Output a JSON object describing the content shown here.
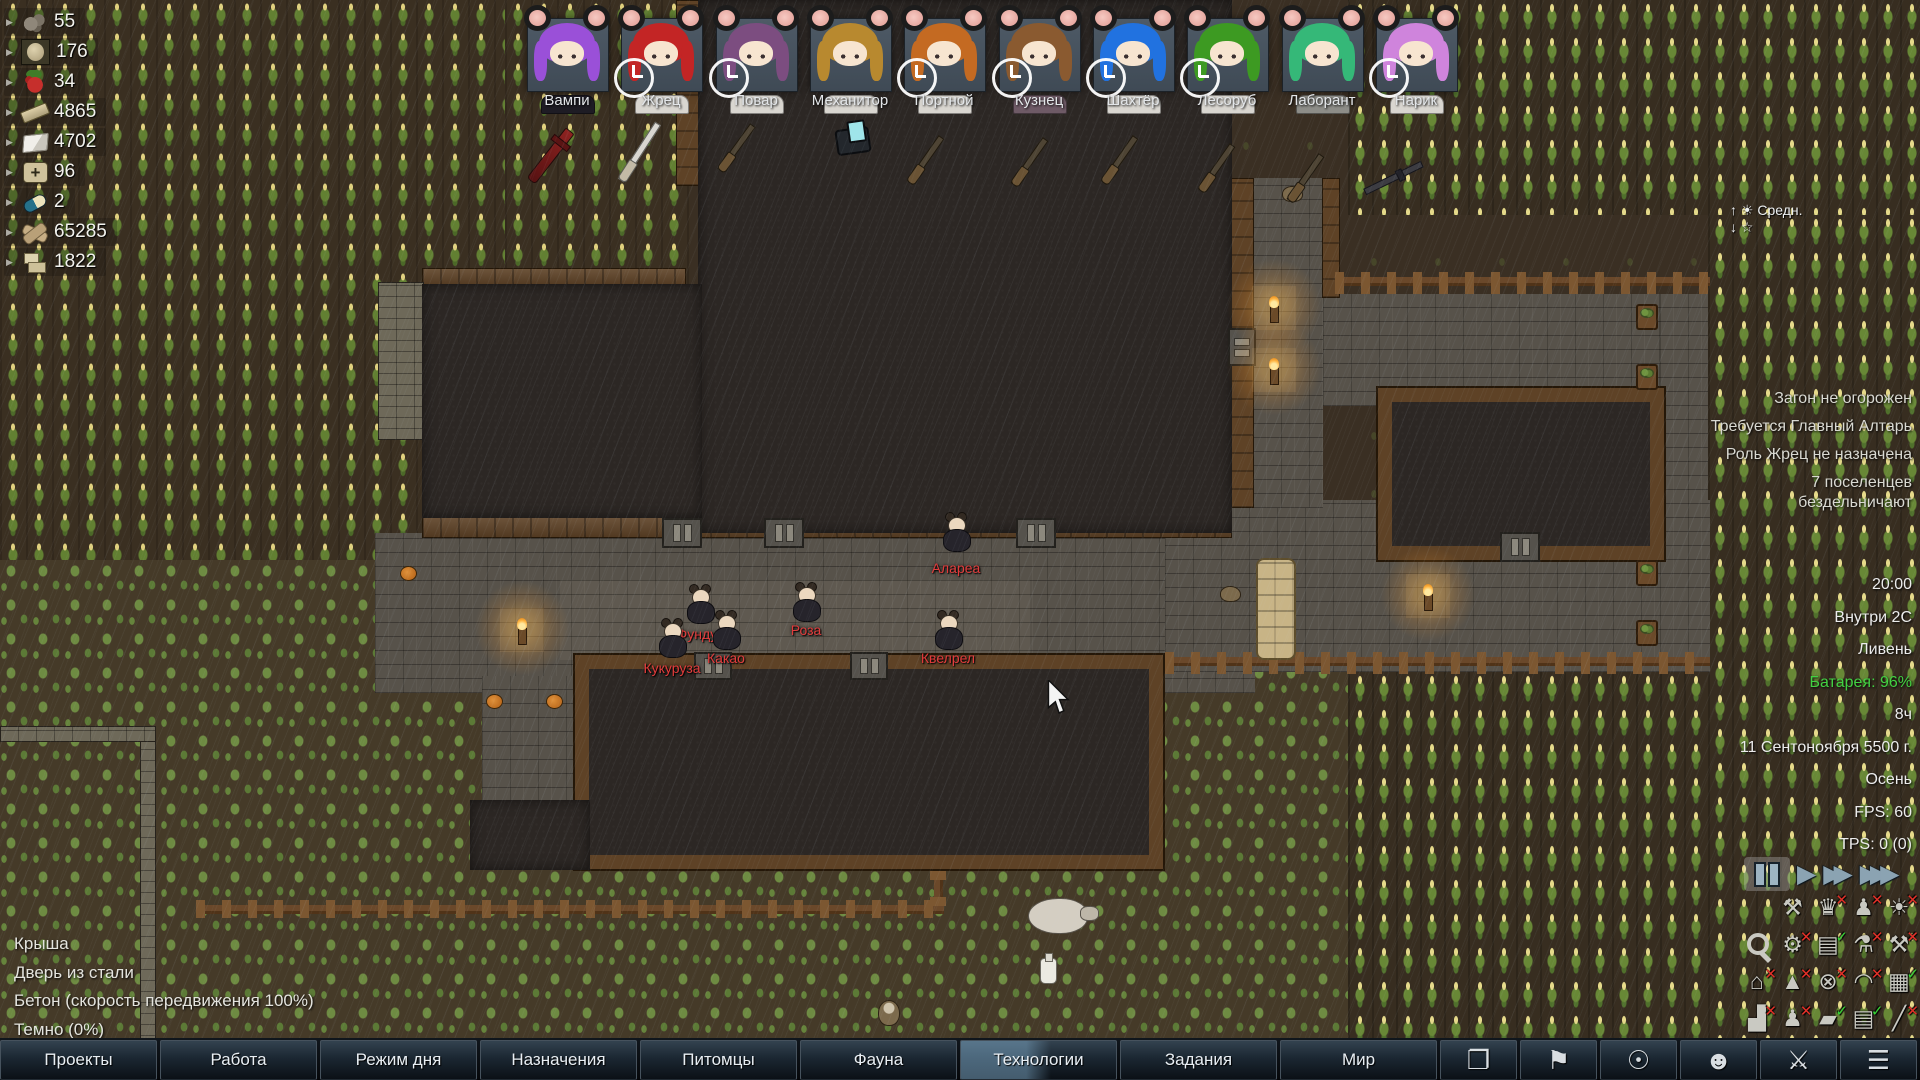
{
  "hud": {
    "resources": [
      {
        "icon": "stone-chunks",
        "count": "55"
      },
      {
        "icon": "egg",
        "count": "176"
      },
      {
        "icon": "berries",
        "count": "34"
      },
      {
        "icon": "steel",
        "count": "4865"
      },
      {
        "icon": "cloth",
        "count": "4702"
      },
      {
        "icon": "medicine",
        "count": "96"
      },
      {
        "icon": "pill",
        "count": "2"
      },
      {
        "icon": "wood",
        "count": "65285"
      },
      {
        "icon": "stone-blocks",
        "count": "1822"
      }
    ],
    "colonists": [
      {
        "name": "Вампи",
        "hair": "#9a50d8",
        "body": "#1e1c24",
        "clock": false
      },
      {
        "name": "Жрец",
        "hair": "#c32525",
        "body": "#d9d6d0",
        "clock": true
      },
      {
        "name": "Повар",
        "hair": "#7c4d80",
        "body": "#d9d6d0",
        "clock": true
      },
      {
        "name": "Механитор",
        "hair": "#b8892f",
        "body": "#d9d6d0",
        "clock": false
      },
      {
        "name": "Портной",
        "hair": "#c46a22",
        "body": "#d9d6d0",
        "clock": true
      },
      {
        "name": "Кузнец",
        "hair": "#8a5a30",
        "body": "#6e5a66",
        "clock": true
      },
      {
        "name": "Шахтёр",
        "hair": "#2172e0",
        "body": "#d9d6d0",
        "clock": true
      },
      {
        "name": "Лесоруб",
        "hair": "#3d9a22",
        "body": "#d9d6d0",
        "clock": true
      },
      {
        "name": "Лаборант",
        "hair": "#35b878",
        "body": "#8d8d88",
        "clock": false
      },
      {
        "name": "Нарик",
        "hair": "#cf84dc",
        "body": "#d9d6d0",
        "clock": true
      }
    ],
    "weather_widget": {
      "line1": "↑ ☀ Средн.",
      "line2": "↓ ☆"
    },
    "alerts": [
      "Загон не огорожен",
      "Требуется Главный Алтарь",
      "Роль Жрец не назначена",
      "7 поселенцев бездельничают"
    ],
    "status": [
      {
        "text": "20:00"
      },
      {
        "text": "Внутри 2C"
      },
      {
        "text": "Ливень"
      },
      {
        "text": "Батарея: 96%",
        "color": "#42d142"
      },
      {
        "text": "8ч"
      },
      {
        "text": "11 Сентоноября 5500 г."
      },
      {
        "text": "Осень"
      },
      {
        "text": "FPS: 60"
      },
      {
        "text": "TPS: 0 (0)"
      }
    ],
    "playback": {
      "selected": "pause",
      "speeds": [
        "pause",
        "play",
        "fast",
        "superfast"
      ]
    },
    "toggles": [
      {
        "name": "tools",
        "glyph": "⚒",
        "state": null
      },
      {
        "name": "trophy",
        "glyph": "♛",
        "state": "x"
      },
      {
        "name": "pawn-paths",
        "glyph": "♟",
        "state": "x"
      },
      {
        "name": "lightbulb",
        "glyph": "☀",
        "state": "x"
      },
      {
        "name": "search",
        "glyph": "mag",
        "state": null
      },
      {
        "name": "factory",
        "glyph": "⚙",
        "state": "x"
      },
      {
        "name": "storage",
        "glyph": "▤",
        "state": "check"
      },
      {
        "name": "thermometer",
        "glyph": "⚗",
        "state": "x"
      },
      {
        "name": "hatchet",
        "glyph": "⚒",
        "state": "x"
      },
      {
        "name": "home-area",
        "glyph": "⌂",
        "state": "x"
      },
      {
        "name": "terrain",
        "glyph": "▲",
        "state": "x"
      },
      {
        "name": "fan",
        "glyph": "⊗",
        "state": "x"
      },
      {
        "name": "roof-overlay",
        "glyph": "◠",
        "state": "x"
      },
      {
        "name": "tiles",
        "glyph": "▦",
        "state": "check"
      },
      {
        "name": "chart",
        "glyph": "▟",
        "state": "x"
      },
      {
        "name": "statue",
        "glyph": "♟",
        "state": "x"
      },
      {
        "name": "zones",
        "glyph": "▰",
        "state": "check"
      },
      {
        "name": "panels",
        "glyph": "▤",
        "state": "check"
      },
      {
        "name": "plans",
        "glyph": "╱",
        "state": "x"
      }
    ],
    "cell_info": [
      "Крыша",
      "Дверь из стали",
      "Бетон (скорость передвижения 100%)",
      "Темно (0%)"
    ],
    "bottom_bar": {
      "buttons": [
        {
          "label": "Проекты",
          "selected": false
        },
        {
          "label": "Работа",
          "selected": false
        },
        {
          "label": "Режим дня",
          "selected": false
        },
        {
          "label": "Назначения",
          "selected": false
        },
        {
          "label": "Питомцы",
          "selected": false
        },
        {
          "label": "Фауна",
          "selected": false
        },
        {
          "label": "Технологии",
          "selected": true
        },
        {
          "label": "Задания",
          "selected": false
        },
        {
          "label": "Мир",
          "selected": false
        }
      ],
      "icon_buttons": [
        {
          "name": "history-book",
          "glyph": "❐"
        },
        {
          "name": "factions-flag",
          "glyph": "⚑"
        },
        {
          "name": "ideology-bulb",
          "glyph": "☉"
        },
        {
          "name": "characters-head",
          "glyph": "☻"
        },
        {
          "name": "apparel-armor",
          "glyph": "⚔"
        },
        {
          "name": "menu",
          "glyph": "☰"
        }
      ]
    }
  },
  "map": {
    "pawn_label_color": "#e23b3b",
    "pawn_labels": [
      "Алареа",
      "Фундук",
      "Роза",
      "Какао",
      "Кукуруза",
      "Квелрел"
    ]
  }
}
